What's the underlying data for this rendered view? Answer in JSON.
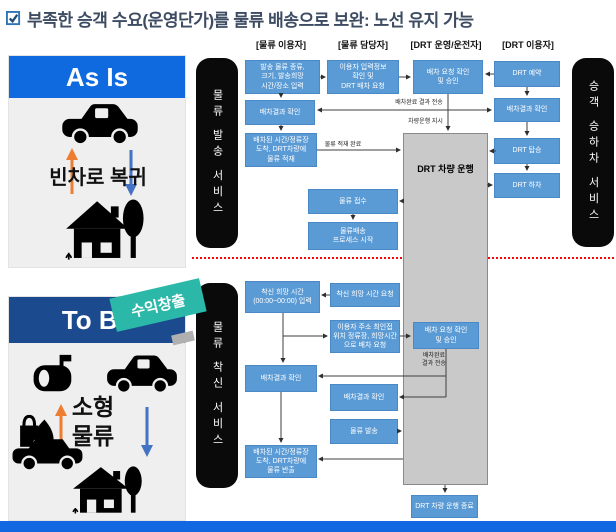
{
  "title": {
    "text": "부족한 승객 수요(운영단가)를 물류 배송으로 보완: 노선 유지 가능"
  },
  "panels": {
    "as_is": {
      "header": "As Is",
      "caption": "빈차로 복귀"
    },
    "to_be": {
      "header": "To Be",
      "banner": "수익창출",
      "caption": "소형\n물류"
    }
  },
  "flow": {
    "column_headers": [
      "[물류 이용자]",
      "[물류 담당자]",
      "[DRT 운영/운전자]",
      "[DRT 이용자]"
    ],
    "bars": {
      "dispatch": "물류 발송 서비스",
      "passenger": "승객 승하차 서비스",
      "receive": "물류 착신 서비스"
    },
    "vehicle_box": "DRT 차량 운행",
    "boxes": {
      "a1": "발송 물류 종류,\n크기, 발송희망\n시간/장소 입력",
      "a2": "이용자 입력정보\n확인 및\nDRT 배차 요청",
      "a3": "배차 요청 확인\n및 승인",
      "a4": "DRT 예약",
      "b1": "배차결과 확인",
      "b4": "배차결과 확인",
      "c1": "배차된 시간/정류장\n도착, DRT차량에\n물류 적재",
      "c4": "DRT 탑승",
      "c5": "DRT 하차",
      "m1": "물류 접수",
      "m2": "물류배송\n프로세스 시작",
      "d1": "착신 희망 시간\n(00:00~00:00) 입력",
      "d2": "착신 희망 시간 요청",
      "d3": "이용자 주소 최인접\n위치 정류장, 희망시간\n으로 배차 요청",
      "d4": "배차 요청 확인\n및 승인",
      "e1": "배차결과 확인",
      "e2": "배차결과 확인",
      "e3": "물류 발송",
      "f1": "배차된 시간/정류장\n도착, DRT차량에\n물류 반출",
      "g": "DRT 차량 운행 종료"
    },
    "labels": {
      "dispatch_result": "배차완료 결과 전송",
      "drive_order": "차량운행 지시",
      "load_done": "물류 적재 완료",
      "dispatch_result2": "배차완료\n결과 전송"
    }
  },
  "colors": {
    "as_is_header": "#0f6ae0",
    "to_be_header": "#1b4a8f",
    "banner_teal": "#2bb8a8",
    "flow_box_blue": "#5b9bd5",
    "vehicle_gray": "#c9c9c9",
    "service_bar_black": "#0a0a0a",
    "bottom_bar_blue": "#1268e0",
    "divider_red": "#f50505",
    "arrow_orange": "#ed7d31",
    "arrow_blue": "#4472c4"
  }
}
